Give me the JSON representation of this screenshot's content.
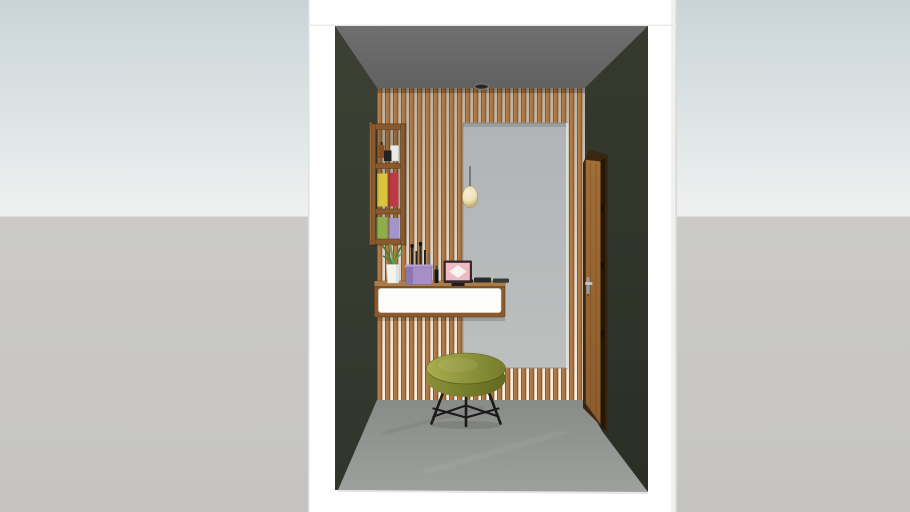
{
  "viewport": {
    "kind": "3d-interior-model-preview",
    "visible_text": [],
    "scene_description": "hallway vanity nook with slat accent wall, mirror, floating console, stool and door"
  },
  "scene": {
    "objects": [
      "white-section-box",
      "gray-ceiling",
      "olive-left-wall",
      "olive-right-wall",
      "wood-slat-accent-wall",
      "tall-mirror",
      "wall-shelf-unit",
      "amber-jar",
      "black-box",
      "white-box",
      "yellow-book",
      "red-book",
      "green-book",
      "lavender-book",
      "pendant-lamp",
      "ceiling-spotlight",
      "floating-vanity-console",
      "potted-plant",
      "makeup-brush-organizer",
      "lipstick",
      "vanity-photo-frame",
      "makeup-palettes",
      "round-stool",
      "wooden-door",
      "door-handle",
      "concrete-floor"
    ]
  },
  "colors": {
    "bg-sky-top": "#cad4d8",
    "bg-sky-mid": "#dee4e5",
    "bg-sky-bottom": "#eff1f0",
    "bg-ground": "#cbcac8",
    "bg-ground-deep": "#c5c4c2",
    "box-white": "#ffffff",
    "box-edge": "#dfe2e3",
    "ceiling": "#6f6f6f",
    "ceiling-deep": "#616161",
    "wall-left": "#3d4134",
    "wall-left-deep": "#30342b",
    "wall-right": "#363a2e",
    "wall-right-deep": "#2a2e25",
    "slat-wood": "#aa733f",
    "slat-wood-dark": "#7a4f26",
    "slat-wood-light": "#c08a50",
    "slat-gap-top": "#b7b1a6",
    "slat-gap-bottom": "#f5f2eb",
    "floor-back": "#898b88",
    "floor-front": "#9ea09d",
    "mirror-top": "#b1b4b5",
    "mirror-bottom": "#bcbfbe",
    "wood-shelf": "#8a5a2e",
    "wood-shelf-dark": "#63401f",
    "wood-shelf-light": "#aa7c47",
    "console-front": "#fdfdfb",
    "stool-top-light": "#a8ae4d",
    "stool-top-dark": "#767c2b",
    "stool-side": "#8a9038",
    "stool-side-dark": "#63691f",
    "stool-leg": "#1b1b1b",
    "door-frame": "#3a2712",
    "door-slab": "#a26d36",
    "door-slab-deep": "#8c5c2b",
    "door-inner": "#241708",
    "door-handle": "#c0c3c3",
    "pendant-shade": "#f0e3ba",
    "pendant-shade-edge": "#c9b27c",
    "pendant-cord": "#4a4a4a",
    "plant-green": "#4e7d38",
    "plant-green-light": "#6b9b51",
    "pot-white": "#f3f3f0",
    "organizer-purple": "#a58fc5",
    "organizer-purple-dark": "#8d76ae",
    "organizer-purple-light": "#b7a3d3",
    "frame-dark": "#352a2b",
    "frame-pink": "#efb9c6",
    "frame-diamond": "#f7f4ef",
    "book-yellow": "#d9c43c",
    "book-red": "#bc3a45",
    "book-green": "#90ad4b",
    "book-lavender": "#a495c9",
    "jar-amber": "#8a4d1d",
    "jar-black": "#222222",
    "jar-white": "#eceae6",
    "spotlight-dark": "#3b3b3b"
  }
}
